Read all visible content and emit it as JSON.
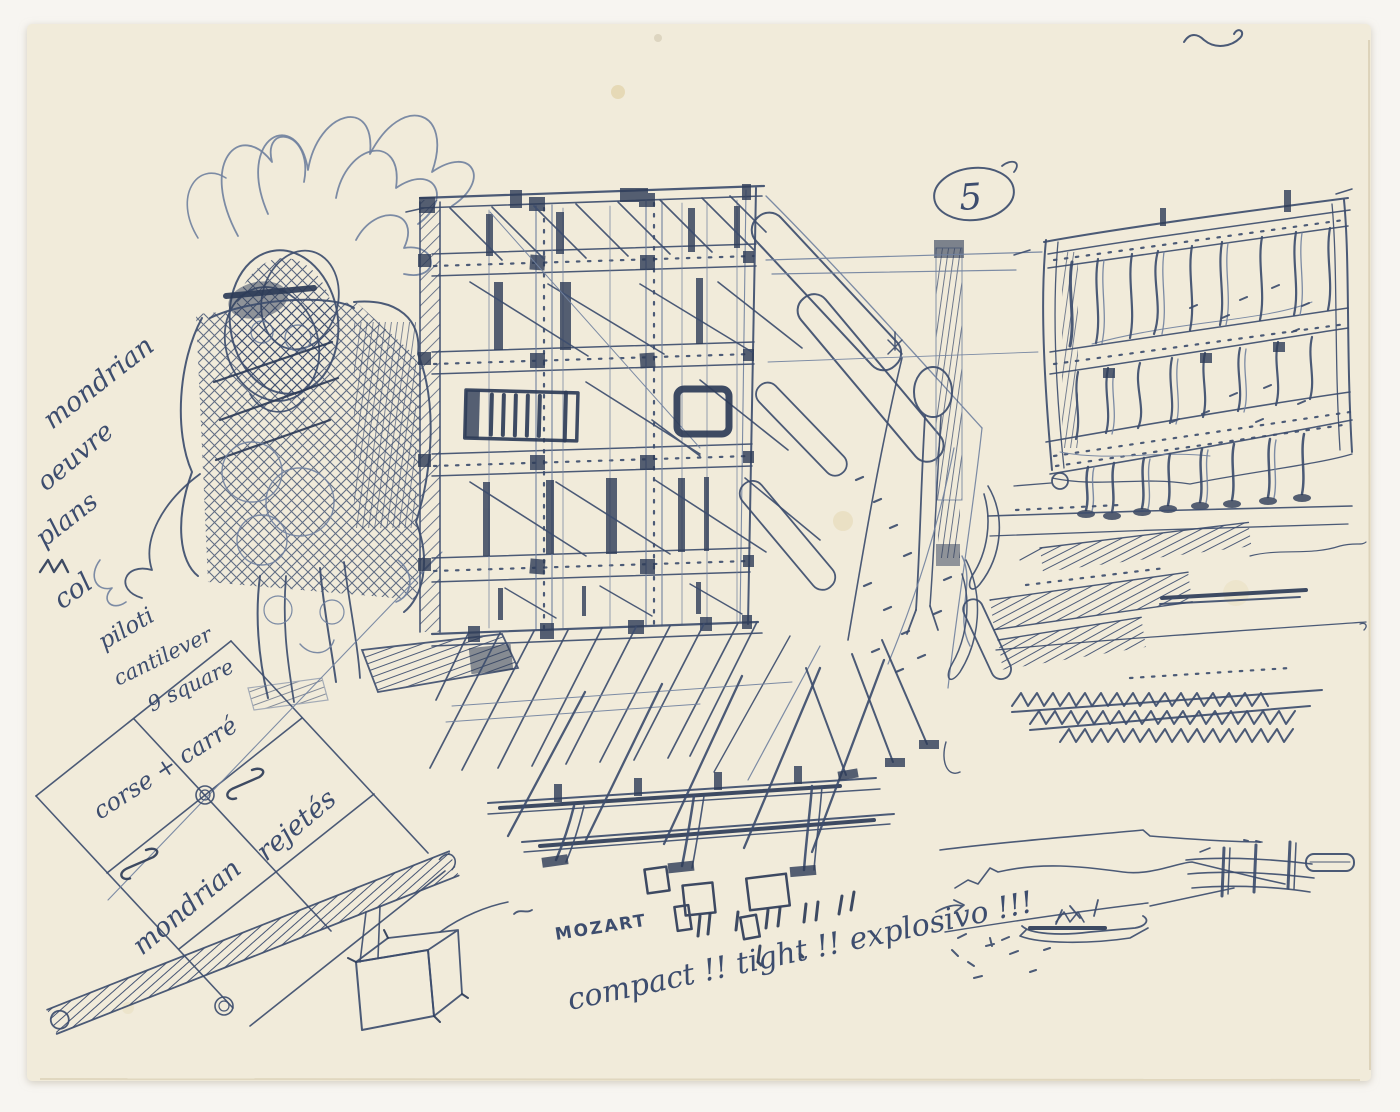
{
  "artwork": {
    "sheet_number": "5",
    "handwritten_notes": {
      "left_column": [
        "mondrian",
        "oeuvre",
        "plans",
        "col",
        "piloti",
        "cantilever",
        "9 square"
      ],
      "grid_label": "corse + carré",
      "grid_caption_1": "mondrian",
      "grid_caption_2": "rejetés",
      "bottom_word": "MOZART",
      "bottom_caption": "compact !! tight !! explosivo !!!"
    },
    "colors": {
      "background": "#f7f5f1",
      "paper": "#f1ebda",
      "ink": "#3d4d6e",
      "ink_dark": "#2e3c58",
      "ink_light": "#72829f"
    }
  }
}
